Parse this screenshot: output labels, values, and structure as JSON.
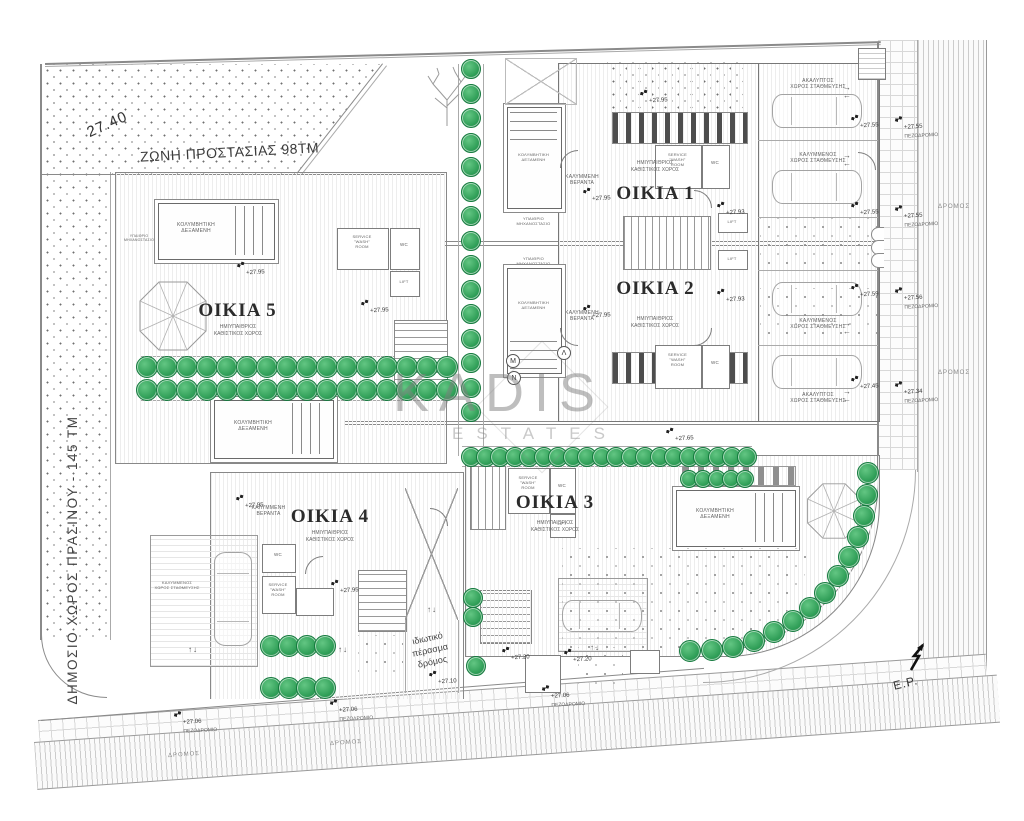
{
  "title_labels": {
    "zone": "ΖΩΝΗ ΠΡΟΣΤΑΣΙΑΣ 98ΤΜ",
    "dim": "27.40",
    "green": "ΔΗΜΟΣΙΟ ΧΩΡΟΣ ΠΡΑΣΙΝΟΥ - 145 ΤΜ",
    "ep": "E.P."
  },
  "watermark": {
    "name": "KADIS",
    "tagline": "ESTATES"
  },
  "houses": [
    {
      "label": "ΟΙΚΙΑ 1",
      "sub": "ΗΜΙΥΠΑΙΘΡΙΟΣ\nΚΑΘΙΣΤΙΚΟΣ ΧΩΡΟΣ"
    },
    {
      "label": "ΟΙΚΙΑ 2",
      "sub": "ΗΜΙΥΠΑΙΘΡΙΟΣ\nΚΑΘΙΣΤΙΚΟΣ ΧΩΡΟΣ"
    },
    {
      "label": "ΟΙΚΙΑ 3",
      "sub": "ΗΜΙΥΠΑΙΘΡΙΟΣ\nΚΑΘΙΣΤΙΚΟΣ ΧΩΡΟΣ"
    },
    {
      "label": "ΟΙΚΙΑ 4",
      "sub": "ΗΜΙΥΠΑΙΘΡΙΟΣ\nΚΑΘΙΣΤΙΚΟΣ ΧΩΡΟΣ"
    },
    {
      "label": "ΟΙΚΙΑ 5",
      "sub": "ΗΜΙΥΠΑΙΘΡΙΟΣ\nΚΑΘΙΣΤΙΚΟΣ ΧΩΡΟΣ"
    }
  ],
  "rooms": {
    "pool": "ΚΟΛΥΜΒΗΤΙΚΗ\nΔΕΞΑΜΕΝΗ",
    "machine": "ΥΠΑΙΘΡΙΟ\nΜΗΧΑΝΟΣΤΑΣΙΟ",
    "veranda": "ΚΑΛΥΜΜΕΝΗ\nΒΕΡΑΝΤΑ",
    "covered_parking": "ΚΑΛΥΜΜΕΝΟΣ\nΧΩΡΟΣ ΣΤΑΘΜΕΥΣΗΣ",
    "open_parking": "ΑΚΑΛΥΠΤΟΣ\nΧΩΡΟΣ ΣΤΑΘΜΕΥΣΗΣ",
    "service": "SERVICE\n\"WASH\"\nROOM",
    "wc": "WC",
    "lift": "LIFT"
  },
  "site": {
    "road": "ΔΡΟΜΟΣ",
    "sidewalk": "ΠΕΖΟΔΡΟΜΙΟ",
    "private_road": "ιδιωτικό\nπέρασμα\nδρόμος"
  },
  "sections": {
    "m": "Μ",
    "l": "Λ",
    "n": "Ν"
  },
  "glyphs": {
    "ud": "↑↓",
    "lr": "→\n←"
  },
  "colors": {
    "tree": "#2f9e57",
    "tree_dark": "#1e7d42",
    "line": "#8a8a8a",
    "text": "#333333"
  },
  "markers": [
    {
      "x": 238,
      "y": 261,
      "t": "+27.95"
    },
    {
      "x": 362,
      "y": 299,
      "t": "+27.95"
    },
    {
      "x": 641,
      "y": 89,
      "t": "+27.95"
    },
    {
      "x": 584,
      "y": 187,
      "t": "+27.95"
    },
    {
      "x": 584,
      "y": 304,
      "t": "+27.95"
    },
    {
      "x": 667,
      "y": 427,
      "t": "+27.65"
    },
    {
      "x": 237,
      "y": 494,
      "t": "+27.95"
    },
    {
      "x": 332,
      "y": 579,
      "t": "+27.95"
    },
    {
      "x": 718,
      "y": 201,
      "t": "+27.93"
    },
    {
      "x": 718,
      "y": 288,
      "t": "+27.93"
    },
    {
      "x": 503,
      "y": 646,
      "t": "+27.20"
    },
    {
      "x": 565,
      "y": 648,
      "t": "+27.20"
    },
    {
      "x": 430,
      "y": 670,
      "t": "+27.10"
    },
    {
      "x": 175,
      "y": 710,
      "t": "+27.06",
      "sub": true
    },
    {
      "x": 331,
      "y": 698,
      "t": "+27.06",
      "sub": true
    },
    {
      "x": 543,
      "y": 684,
      "t": "+27.06",
      "sub": true
    },
    {
      "x": 852,
      "y": 114,
      "t": "+27.55"
    },
    {
      "x": 896,
      "y": 115,
      "t": "+27.55",
      "sub": true
    },
    {
      "x": 852,
      "y": 201,
      "t": "+27.55"
    },
    {
      "x": 896,
      "y": 204,
      "t": "+27.55",
      "sub": true
    },
    {
      "x": 852,
      "y": 283,
      "t": "+27.59"
    },
    {
      "x": 896,
      "y": 286,
      "t": "+27.56",
      "sub": true
    },
    {
      "x": 852,
      "y": 375,
      "t": "+27.45"
    },
    {
      "x": 896,
      "y": 380,
      "t": "+27.34",
      "sub": true
    }
  ],
  "arrows": [
    {
      "x": 188,
      "y": 646,
      "k": "ud"
    },
    {
      "x": 338,
      "y": 646,
      "k": "ud"
    },
    {
      "x": 427,
      "y": 606,
      "k": "ud"
    },
    {
      "x": 590,
      "y": 644,
      "k": "ud"
    },
    {
      "x": 843,
      "y": 84,
      "k": "lr"
    },
    {
      "x": 843,
      "y": 152,
      "k": "lr"
    },
    {
      "x": 843,
      "y": 320,
      "k": "lr"
    },
    {
      "x": 843,
      "y": 388,
      "k": "lr"
    }
  ],
  "tree_groups": [
    {
      "kind": "col",
      "x": 470,
      "y": 68,
      "dy": 24.5,
      "n": 15,
      "r": 9
    },
    {
      "kind": "row",
      "y": 366,
      "x": 146,
      "dx": 20,
      "n": 16,
      "r": 10
    },
    {
      "kind": "row",
      "y": 389,
      "x": 146,
      "dx": 20,
      "n": 16,
      "r": 10
    },
    {
      "kind": "row",
      "y": 456,
      "x": 470,
      "dx": 14.5,
      "n": 20,
      "r": 9
    },
    {
      "kind": "row",
      "y": 478,
      "x": 688,
      "dx": 14,
      "n": 5,
      "r": 8
    },
    {
      "kind": "arc",
      "cx": 695,
      "cy": 478,
      "rad": 172,
      "a0": -2,
      "a1": 92,
      "n": 14,
      "r": 10
    },
    {
      "kind": "row",
      "y": 645,
      "x": 270,
      "dx": 18,
      "n": 4,
      "r": 10
    },
    {
      "kind": "row",
      "y": 687,
      "x": 270,
      "dx": 18,
      "n": 4,
      "r": 10
    },
    {
      "kind": "col",
      "x": 472,
      "y": 597,
      "dy": 19,
      "n": 2,
      "r": 9
    },
    {
      "kind": "col",
      "x": 475,
      "y": 665,
      "dy": 0,
      "n": 1,
      "r": 9
    }
  ]
}
